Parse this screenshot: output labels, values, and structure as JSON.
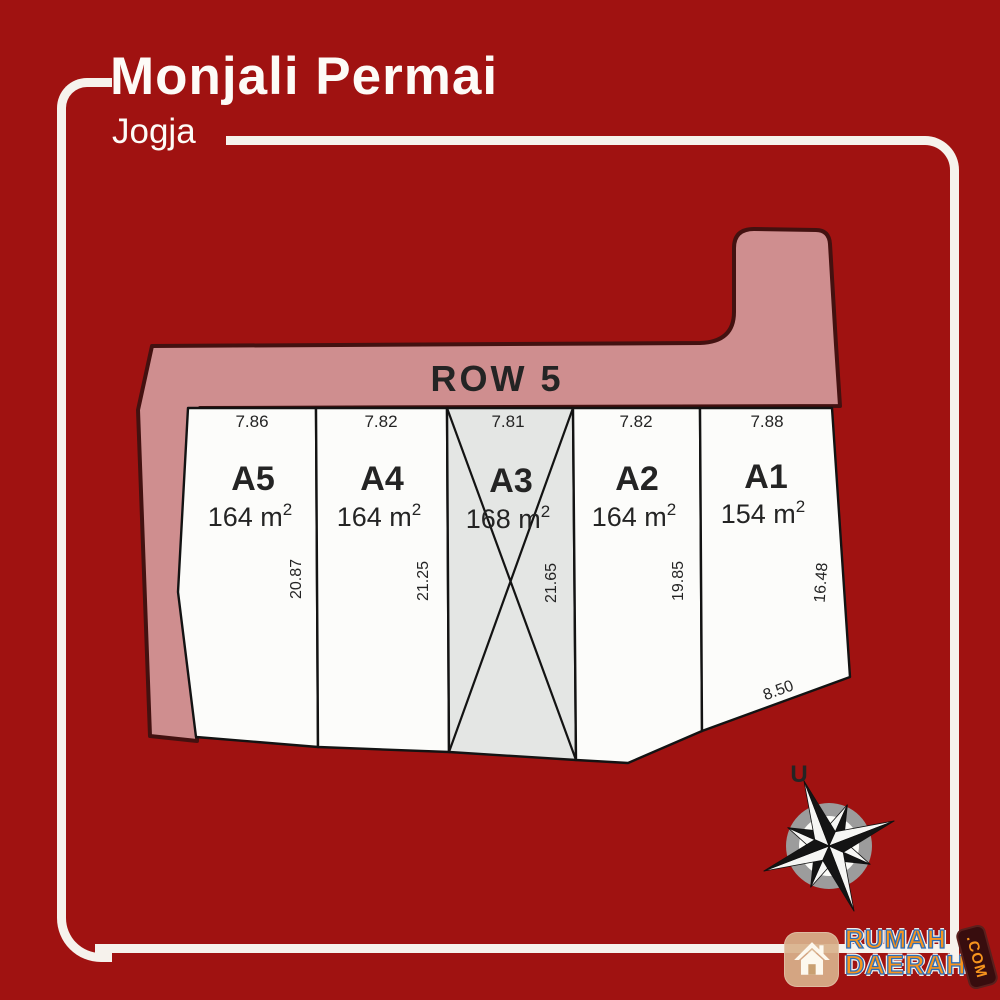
{
  "header": {
    "title": "Monjali Permai",
    "subtitle": "Jogja"
  },
  "site_plan": {
    "road_label": "ROW 5",
    "plots": [
      {
        "id": "A5",
        "area": "164 m",
        "area_sup": "2",
        "front": "7.86",
        "depth": "20.87",
        "status": "available"
      },
      {
        "id": "A4",
        "area": "164 m",
        "area_sup": "2",
        "front": "7.82",
        "depth": "21.25",
        "status": "available"
      },
      {
        "id": "A3",
        "area": "168 m",
        "area_sup": "2",
        "front": "7.81",
        "depth": "21.65",
        "status": "sold"
      },
      {
        "id": "A2",
        "area": "164 m",
        "area_sup": "2",
        "front": "7.82",
        "depth": "19.85",
        "status": "available"
      },
      {
        "id": "A1",
        "area": "154 m",
        "area_sup": "2",
        "front": "7.88",
        "depth": "16.48",
        "rear": "8.50",
        "status": "available"
      }
    ]
  },
  "compass": {
    "north_label": "U"
  },
  "watermark": {
    "brand_line1": "RUMAH",
    "brand_line2": "DAERAH",
    "brand_suffix": ".COM"
  },
  "colors": {
    "background": "#a01211",
    "road": "#cf8e8f",
    "road_text": "#5c1f1f",
    "plot": "#fcfcfa",
    "plot_sold": "#e4e6e4",
    "frame": "#f6f2ec",
    "logo_orange": "#f7941d",
    "logo_blue": "#2b6cb8"
  }
}
